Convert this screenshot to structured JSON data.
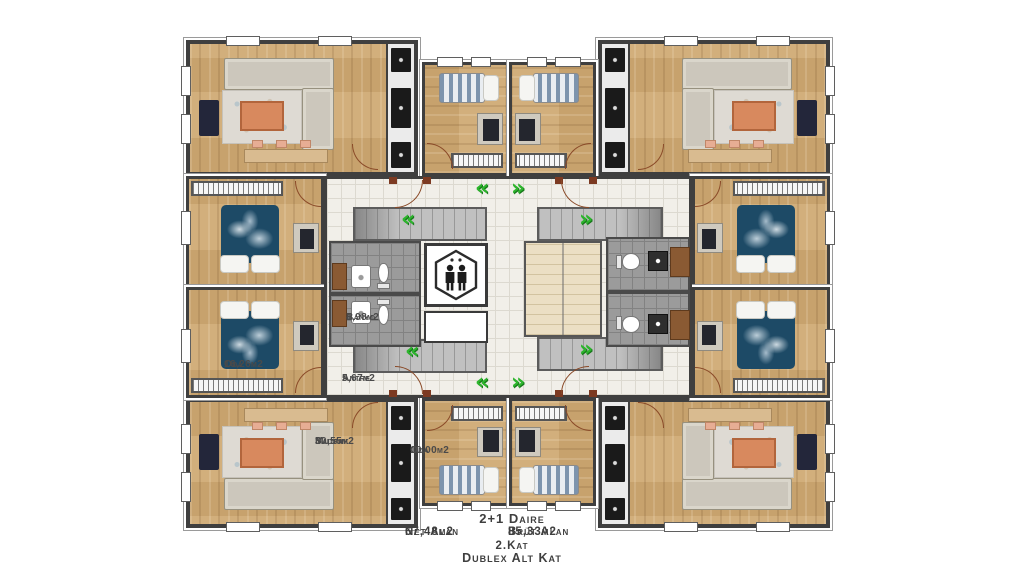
{
  "plan": {
    "rooms": {
      "oda_buyuk": {
        "name": "Oda",
        "area": "16,26m2"
      },
      "banyo": {
        "name": "Banyo",
        "area": "4,98m2"
      },
      "antre": {
        "name": "Antre",
        "area": "5,67m2"
      },
      "salon_mutfak": {
        "line1": "Salon",
        "line2": "Mutfak",
        "area": "30,55m2"
      },
      "oda_kucuk": {
        "name": "Oda",
        "area": "10,00m2"
      }
    },
    "footer": {
      "unit_type": "2+1 Daire",
      "net_label": "Net Alan",
      "net_value": "67,48m2",
      "brut_label": "Brüt Alan",
      "brut_value": "85,33m2",
      "floor": "2.Kat",
      "floor_detail": "Dublex Alt Kat"
    },
    "icons": {
      "chevron_left": "«",
      "chevron_right": "»",
      "elevator": "elevator-two-people-icon"
    },
    "colors": {
      "wood_floor": "#cda873",
      "wall": "#3f3f3f",
      "hall_tile": "#f1efe9",
      "bath_tile": "#9b9b9b",
      "stair_gray": "#c0c0c0",
      "stair_cream": "#ebdfc4",
      "bed_navy": "#1d4a66",
      "coffee_table_orange": "#d8895e",
      "door_maroon": "#7c3a22",
      "arrow_green": "#2db52d",
      "label_text": "#4a4a4a"
    }
  }
}
